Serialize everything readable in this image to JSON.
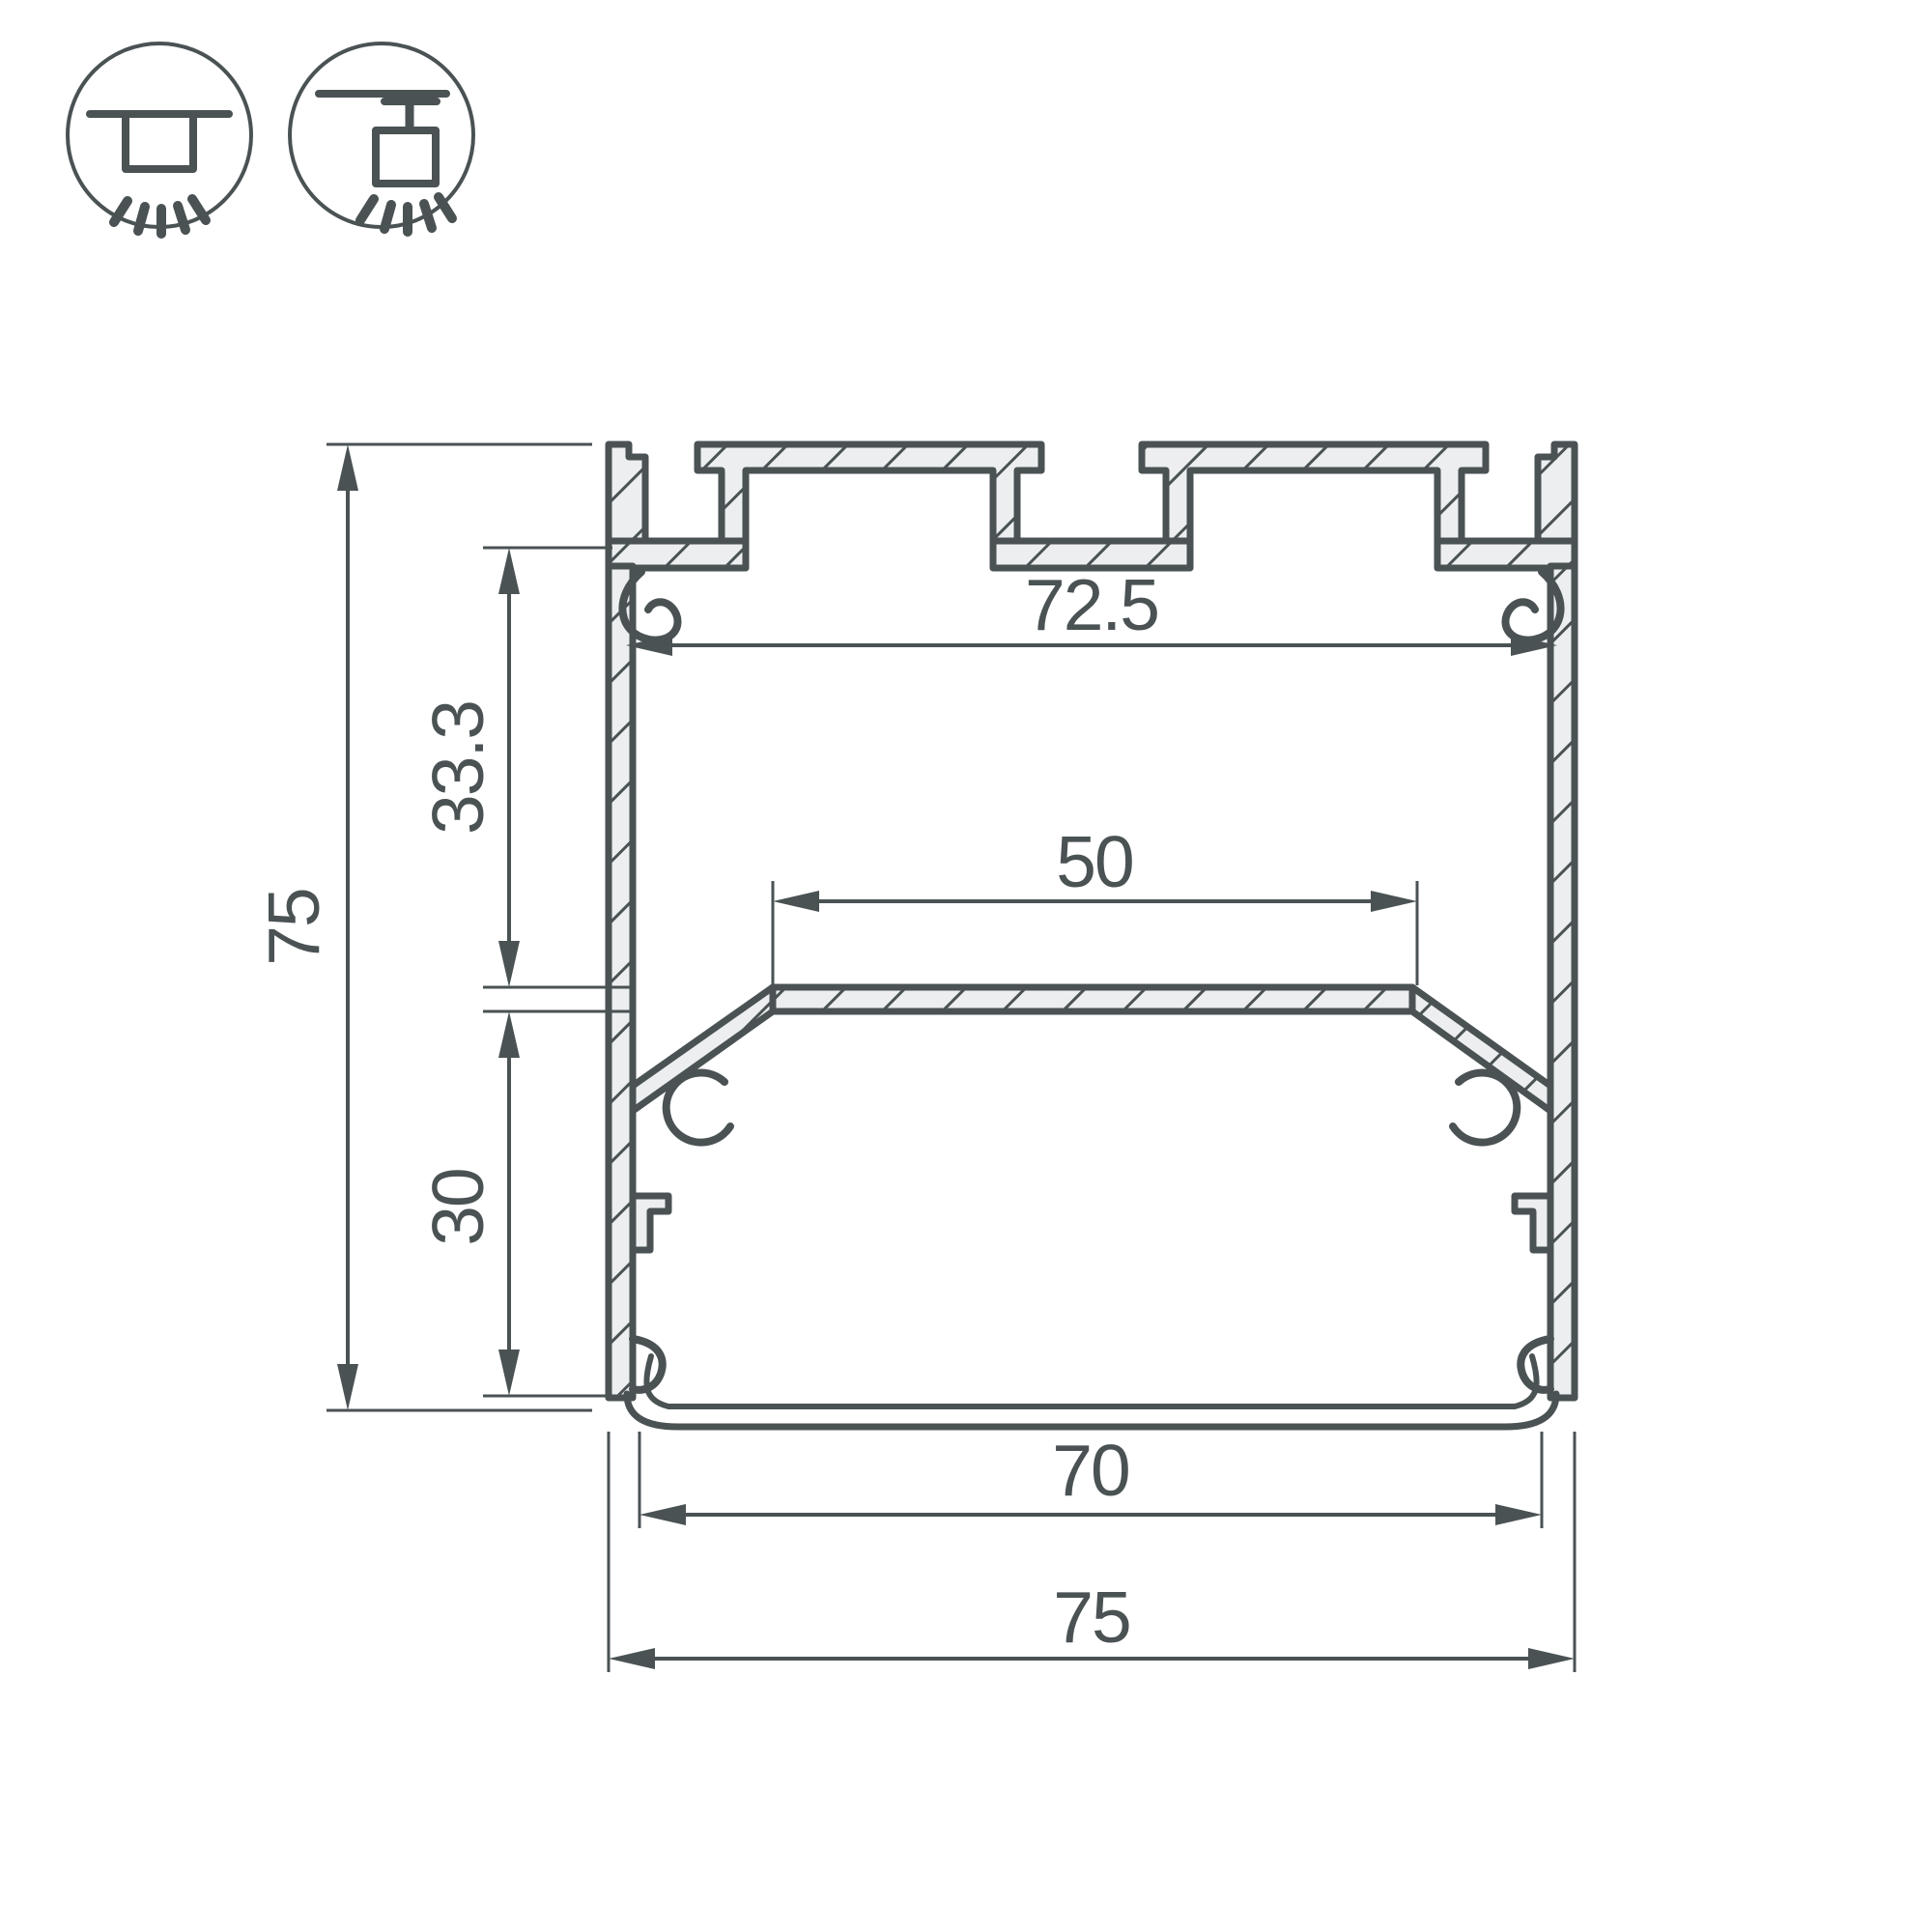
{
  "drawing": {
    "type": "technical-cross-section",
    "subject": "aluminium-led-profile",
    "line_color": "#4a5254",
    "body_fill": "#eceeef",
    "background": "#ffffff"
  },
  "mount_icons": [
    {
      "name": "surface-mount-icon",
      "meaning": "ceiling surface mounted luminaire"
    },
    {
      "name": "pendant-mount-icon",
      "meaning": "suspended / pendant mounted luminaire"
    }
  ],
  "dimensions": {
    "inner_width_top": {
      "value": "72.5",
      "orientation": "horizontal"
    },
    "led_shelf_width": {
      "value": "50",
      "orientation": "horizontal"
    },
    "upper_section_height": {
      "value": "33.3",
      "orientation": "vertical"
    },
    "total_height": {
      "value": "75",
      "orientation": "vertical"
    },
    "lower_section_height": {
      "value": "30",
      "orientation": "vertical"
    },
    "inner_width_bottom": {
      "value": "70",
      "orientation": "horizontal"
    },
    "total_width": {
      "value": "75",
      "orientation": "horizontal"
    }
  }
}
